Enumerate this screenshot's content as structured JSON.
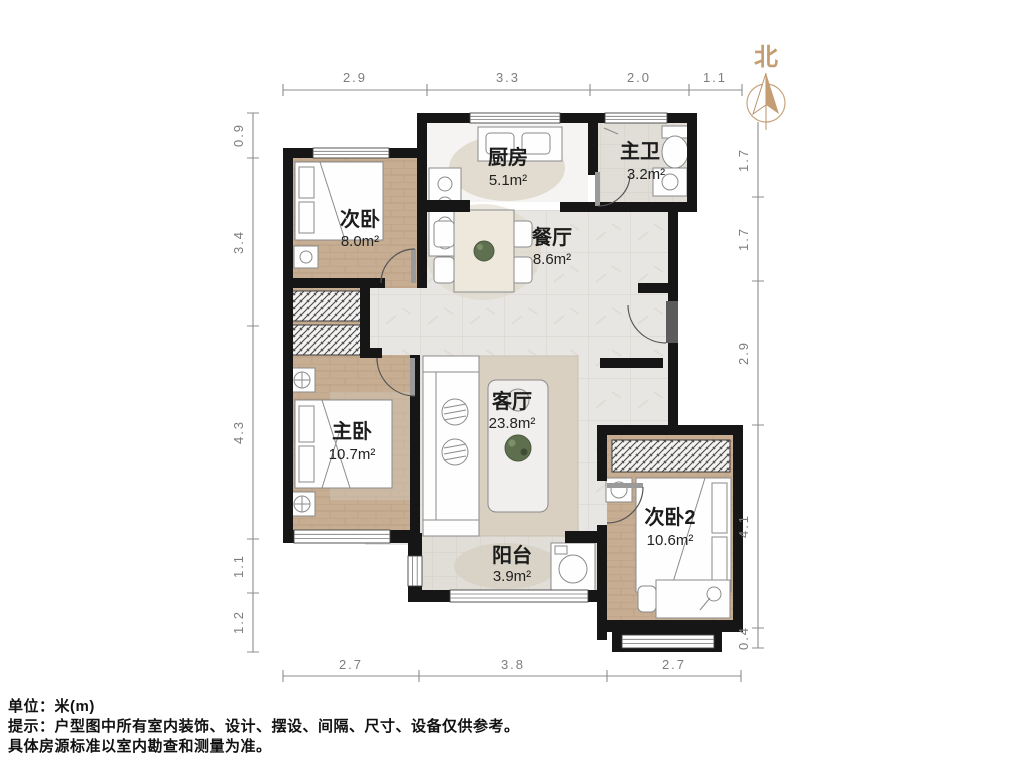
{
  "compass": {
    "north_label": "北"
  },
  "rooms": {
    "kitchen": {
      "name": "厨房",
      "area": "5.1m²"
    },
    "master_bath": {
      "name": "主卫",
      "area": "3.2m²"
    },
    "bedroom_a": {
      "name": "次卧",
      "area": "8.0m²"
    },
    "dining": {
      "name": "餐厅",
      "area": "8.6m²"
    },
    "master_bedroom": {
      "name": "主卧",
      "area": "10.7m²"
    },
    "living": {
      "name": "客厅",
      "area": "23.8m²"
    },
    "bedroom_b": {
      "name": "次卧2",
      "area": "10.6m²"
    },
    "balcony": {
      "name": "阳台",
      "area": "3.9m²"
    }
  },
  "dimensions": {
    "top": [
      "2.9",
      "3.3",
      "2.0",
      "1.1"
    ],
    "left": [
      "0.9",
      "3.4",
      "4.3",
      "1.1",
      "1.2"
    ],
    "right": [
      "1.7",
      "1.7",
      "2.9",
      "4.1",
      "0.4"
    ],
    "bottom": [
      "2.7",
      "3.8",
      "2.7"
    ]
  },
  "notes": {
    "unit": "单位：米(m)",
    "tip": "提示：户型图中所有室内装饰、设计、摆设、间隔、尺寸、设备仅供参考。",
    "tip2": "具体房源标准以室内勘查和测量为准。"
  },
  "colors": {
    "wall": "#161616",
    "wood_floor": "#c7ad92",
    "tile_floor": "#e8e6e2",
    "north_accent": "#c59d73",
    "dim_line": "#8c8c8c"
  }
}
